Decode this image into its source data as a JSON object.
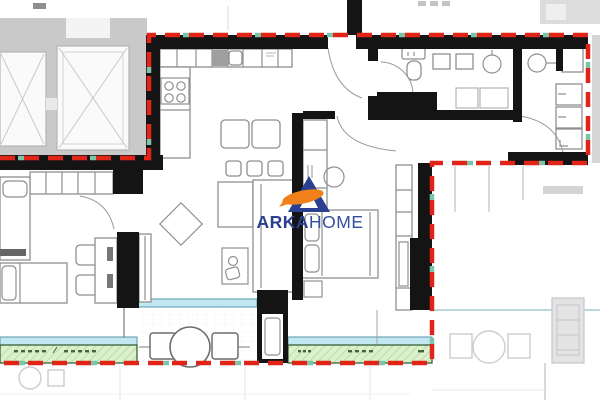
{
  "watermark": {
    "brand_primary": "ARKA",
    "brand_secondary": "HOME"
  },
  "palette": {
    "paper": "#ffffff",
    "boundary_red": "#e02518",
    "boundary_teal": "#7cc5a8",
    "wall_black": "#141414",
    "furniture_gray": "#8f8f8f",
    "furniture_light": "#b5b5b5",
    "faded_gray": "#cccccc",
    "core_bg": "#c9c9c9",
    "shaft_white": "#fafafa",
    "glass_fill": "#c3e7f0",
    "glass_edge": "#5697ab",
    "planter_fill": "#ddf0cd",
    "planter_hatch": "#a9d695",
    "planter_border": "#2c5530",
    "planter_mark": "#43653c",
    "logo_triangle": "#2b3f90",
    "logo_swoosh": "#f08019",
    "brand_primary_color": "#2b3f90",
    "brand_secondary_color": "#33509f"
  },
  "plan": {
    "kind": "apartment-floor-plan",
    "room_labels_visible": false,
    "dimension_marks": "illegible tick marks only",
    "features": [
      "elevator-core",
      "kitchen",
      "dining-area",
      "living-area",
      "bedroom",
      "bathroom",
      "wc",
      "hallway",
      "entry-door",
      "balcony",
      "planter-strips",
      "neighboring-unit-faded"
    ]
  }
}
